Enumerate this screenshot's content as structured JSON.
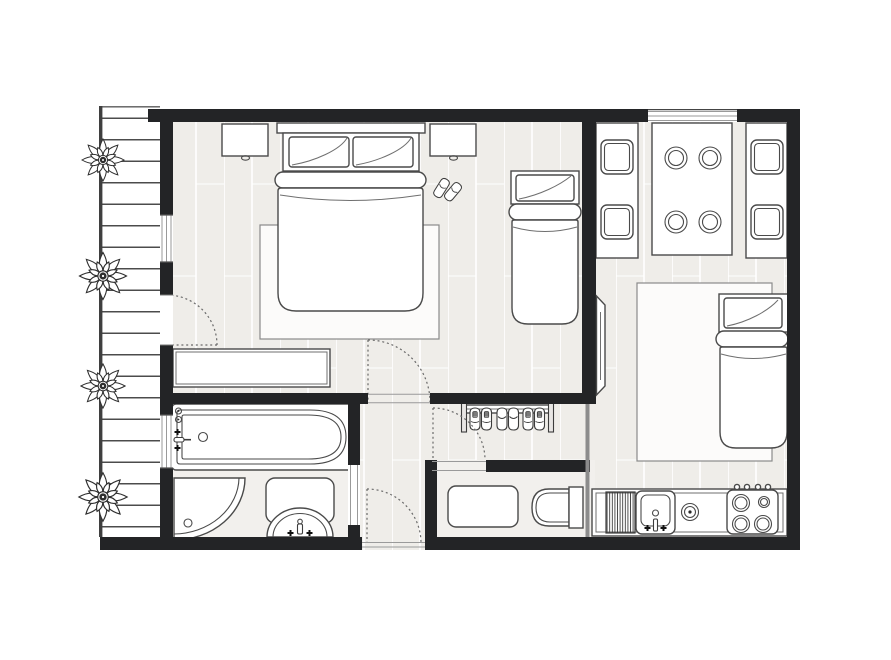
{
  "title": "Studio Apartment Floor Plan",
  "canvas": {
    "width": 891,
    "height": 660,
    "background": "#ffffff"
  },
  "colors": {
    "wall": "#232426",
    "line": "#4a4a4a",
    "floor": "#efede9",
    "floor_tile": "#f2f0ed",
    "plank": "#ffffff",
    "rug": "#fcfbfa",
    "door_dash": "#6a6a6a",
    "deck_line": "#4c4c4c",
    "balcony": "#ffffff"
  },
  "rooms": {
    "bedroom": {
      "name": "Bedroom",
      "items": [
        "double-bed",
        "pillow-left",
        "pillow-right",
        "bed-rug",
        "nightstand-left",
        "nightstand-right",
        "slippers",
        "single-bed",
        "dresser"
      ]
    },
    "bathroom": {
      "name": "Bathroom",
      "items": [
        "bathtub",
        "tub-faucet",
        "corner-shower",
        "washbasin",
        "bath-mat"
      ]
    },
    "hallway": {
      "name": "Hallway",
      "items": [
        "shoe-rack",
        "sneakers-pair",
        "slippers-pair",
        "sneakers-pair"
      ]
    },
    "wc": {
      "name": "WC / Laundry",
      "items": [
        "washing-machine",
        "toilet"
      ]
    },
    "kitchen": {
      "name": "Kitchen-Living Room",
      "items": [
        "bench-seat-left",
        "dining-table",
        "bench-seat-right",
        "dining-plates",
        "wall-tv",
        "single-bed",
        "area-rug",
        "kitchen-counter",
        "drainboard",
        "kitchen-sink",
        "ring-burner",
        "stove-top",
        "stove-knobs"
      ]
    },
    "balcony": {
      "name": "Balcony",
      "items": [
        "railing",
        "deck-planks",
        "plant",
        "plant",
        "plant",
        "plant"
      ]
    }
  },
  "openings": {
    "windows": [
      "bedroom-balcony-window",
      "bathroom-balcony-window",
      "kitchen-window"
    ],
    "doors": [
      "balcony-door",
      "bedroom-door",
      "entrance-door",
      "wc-door",
      "bathroom-doorway"
    ]
  },
  "counts": {
    "beds": 3,
    "plants": 4,
    "dining_plates": 4,
    "stove_burners": 4,
    "shoe_pairs_on_rack": 3,
    "door_swings": 4,
    "windows": 3
  }
}
